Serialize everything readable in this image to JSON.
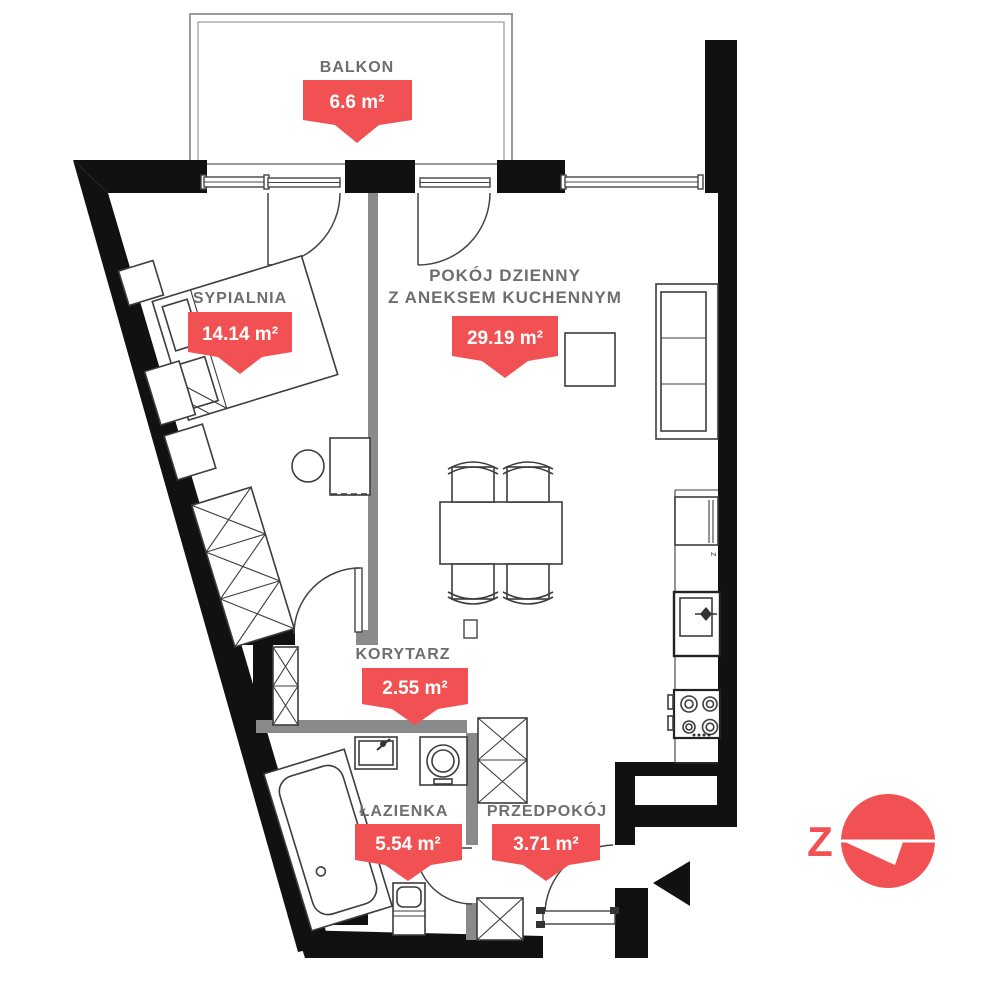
{
  "rooms": [
    {
      "id": "balkon",
      "name": "BALKON",
      "area": "6.6 m²"
    },
    {
      "id": "sypialnia",
      "name": "SYPIALNIA",
      "area": "14.14 m²"
    },
    {
      "id": "pokoj-dzienny",
      "name_line1": "POKÓJ DZIENNY",
      "name_line2": "Z ANEKSEM KUCHENNYM",
      "area": "29.19 m²"
    },
    {
      "id": "korytarz",
      "name": "KORYTARZ",
      "area": "2.55 m²"
    },
    {
      "id": "lazienka",
      "name": "ŁAZIENKA",
      "area": "5.54 m²"
    },
    {
      "id": "przedpokoj",
      "name": "PRZEDPOKÓJ",
      "area": "3.71 m²"
    }
  ],
  "kitchen": {
    "appliance_label": "z"
  },
  "compass": {
    "direction_label": "Z"
  },
  "colors": {
    "tag_red": "#f15152",
    "wall_black": "#111111",
    "partition_gray": "#8a8a8a",
    "label_gray": "#6e6e6e"
  }
}
